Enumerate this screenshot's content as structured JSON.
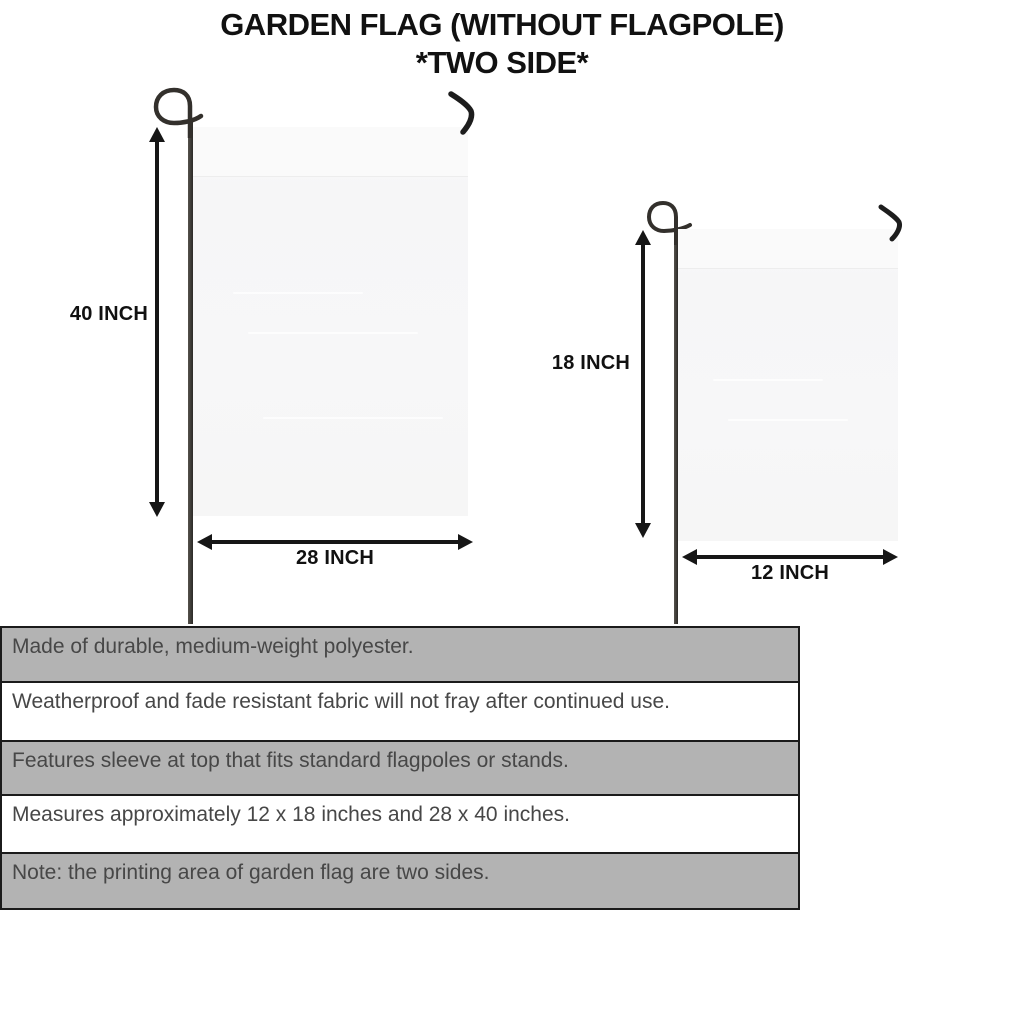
{
  "title": {
    "line1": "GARDEN FLAG (WITHOUT FLAGPOLE)",
    "line2": "*TWO SIDE*"
  },
  "large_flag": {
    "height_label": "40 INCH",
    "width_label": "28 INCH"
  },
  "small_flag": {
    "height_label": "18 INCH",
    "width_label": "12 INCH"
  },
  "features": {
    "rows": [
      {
        "text": "Made of durable, medium-weight polyester."
      },
      {
        "text": "Weatherproof and fade resistant fabric will not fray after continued use."
      },
      {
        "text": "Features sleeve at top that fits standard flagpoles or stands."
      },
      {
        "text": "Measures approximately 12 x 18 inches and 28 x 40 inches."
      },
      {
        "text": "Note: the printing area of garden flag are two sides."
      }
    ]
  },
  "colors": {
    "row_gray": "#b3b3b3",
    "row_white": "#ffffff",
    "border_dark": "#1b1b1b",
    "flag_fill": "#f7f7f8",
    "pole_dark": "#2c2a27",
    "label_black": "#111111",
    "feature_text": "#474747"
  }
}
